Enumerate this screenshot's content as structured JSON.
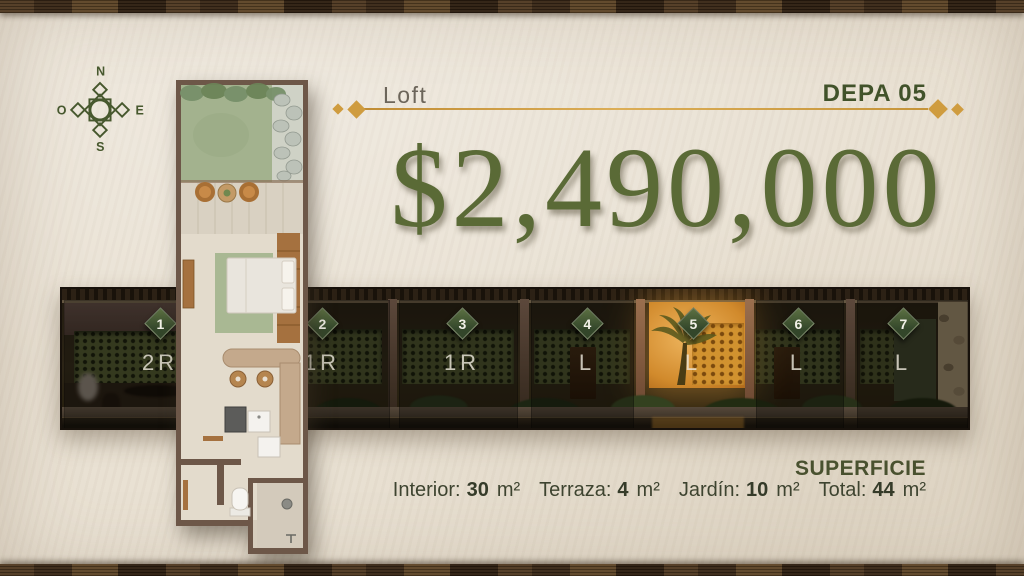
{
  "header": {
    "category": "Loft",
    "unit_code": "DEPA 05"
  },
  "price": {
    "amount": "$2,490,000"
  },
  "compass": {
    "n": "N",
    "s": "S",
    "e": "E",
    "w": "O"
  },
  "facade": {
    "highlighted_unit": "5",
    "units": [
      {
        "number": "1",
        "type": "2R"
      },
      {
        "number": "2",
        "type": "1R"
      },
      {
        "number": "3",
        "type": "1R"
      },
      {
        "number": "4",
        "type": "L"
      },
      {
        "number": "5",
        "type": "L"
      },
      {
        "number": "6",
        "type": "L"
      },
      {
        "number": "7",
        "type": "L"
      }
    ]
  },
  "superficie": {
    "title": "SUPERFICIE",
    "measurements": [
      {
        "label": "Interior:",
        "value": "30",
        "unit": "m²"
      },
      {
        "label": "Terraza:",
        "value": "4",
        "unit": "m²"
      },
      {
        "label": "Jardín:",
        "value": "10",
        "unit": "m²"
      },
      {
        "label": "Total:",
        "value": "44",
        "unit": "m²"
      }
    ]
  },
  "colors": {
    "background_beige": "#e9e1d3",
    "wood_frame": "#43301c",
    "accent_gold": "#cf9c3f",
    "brand_green": "#41522a",
    "price_green": "#5a6a36",
    "highlight_amber": "#d18a2c"
  }
}
